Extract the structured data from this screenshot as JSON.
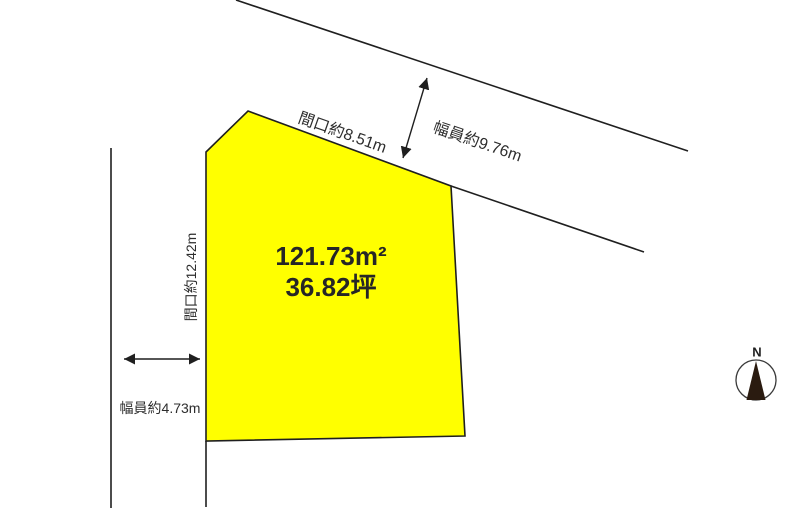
{
  "colors": {
    "plot_fill": "#ffff00",
    "line": "#1f1f1f",
    "text": "#2d2d2d",
    "compass_needle": "#2a1b10"
  },
  "plot": {
    "area_m2": "121.73m²",
    "area_tsubo": "36.82坪"
  },
  "labels": {
    "frontage_top": "間口約8.51m",
    "road_width_top": "幅員約9.76m",
    "frontage_left": "間口約12.42m",
    "road_width_left": "幅員約4.73m"
  },
  "compass": {
    "north": "N"
  }
}
